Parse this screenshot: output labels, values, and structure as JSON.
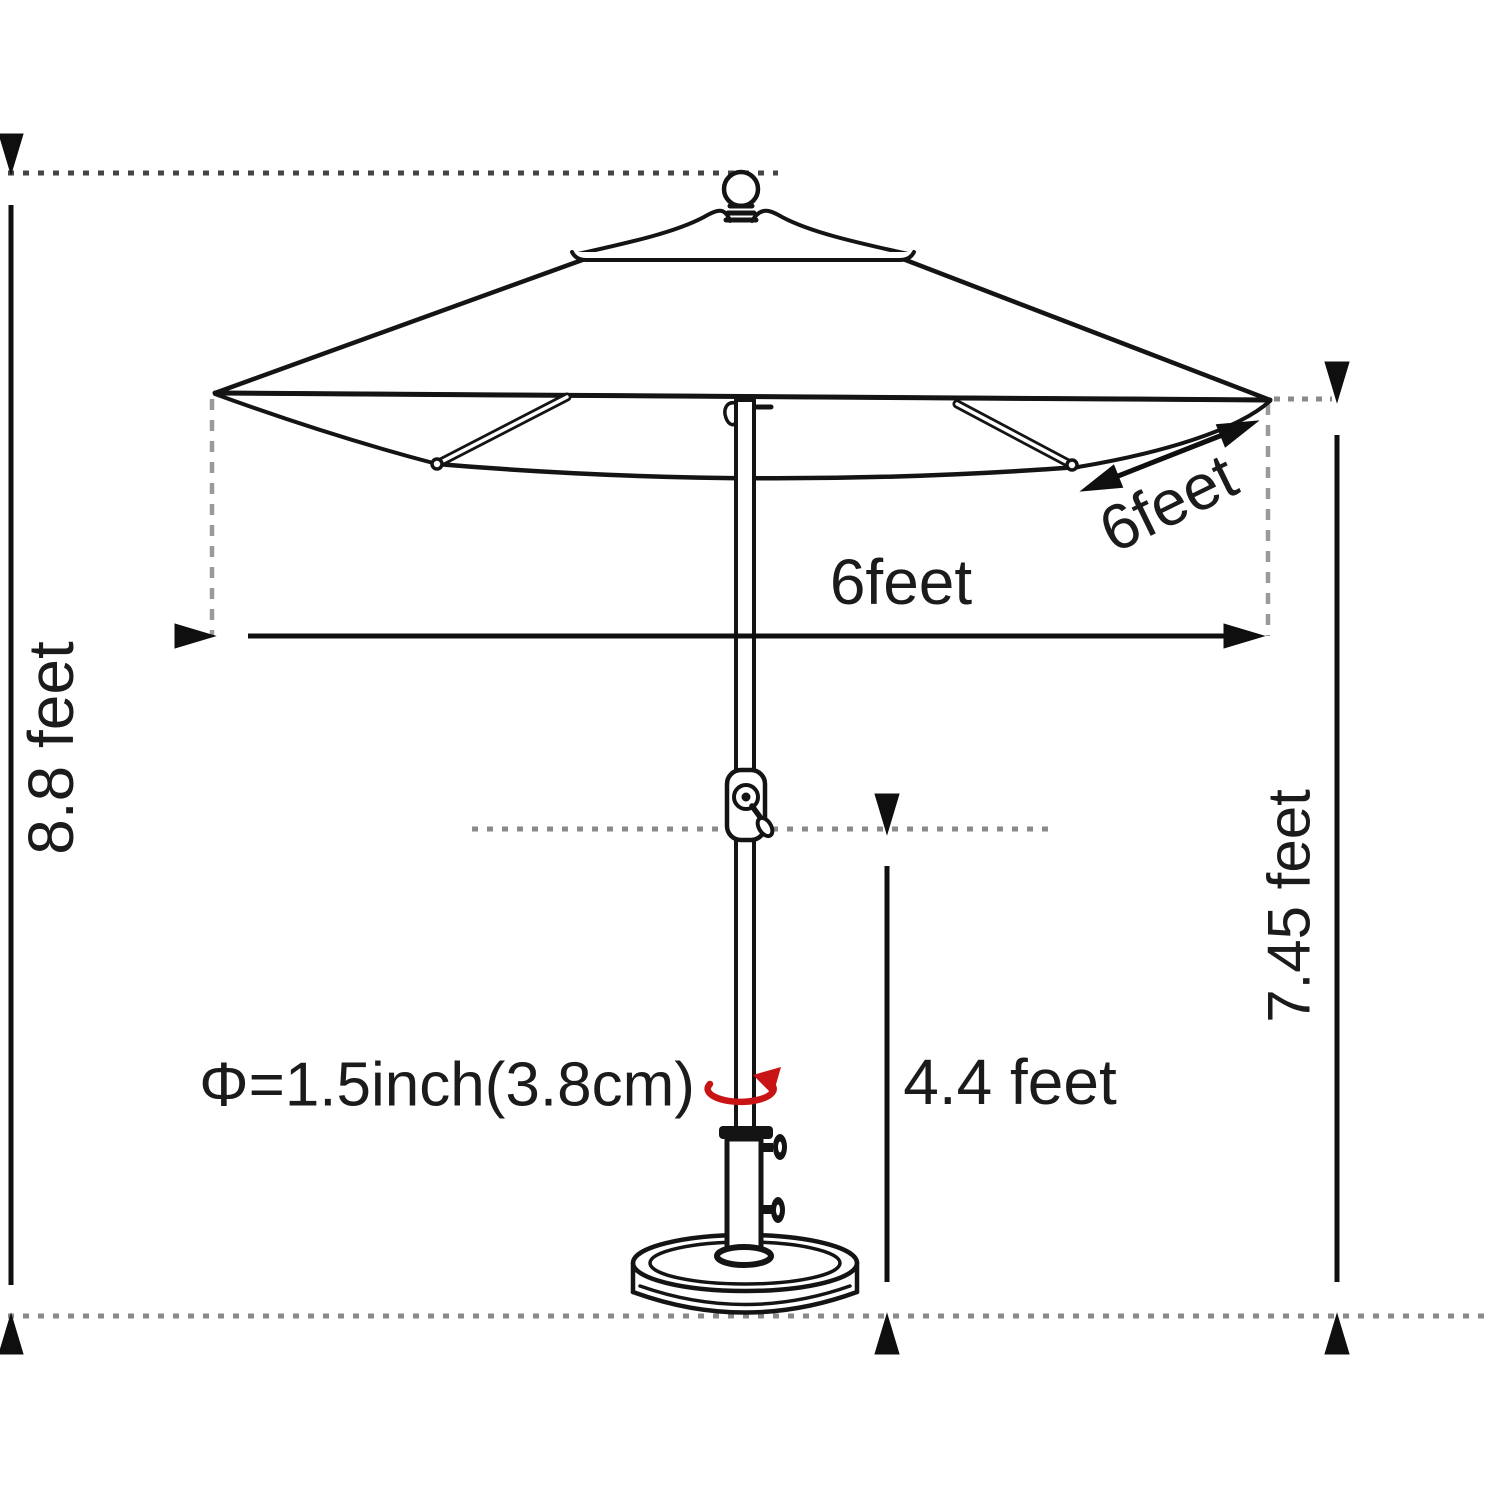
{
  "diagram": {
    "title": "Patio umbrella dimension drawing",
    "labels": {
      "overall_height": "8.8 feet",
      "canopy_clearance_height": "7.45 feet",
      "canopy_width": "6feet",
      "canopy_side_depth": "6feet",
      "ground_to_crank_height": "4.4 feet",
      "pole_diameter": "Φ=1.5inch(3.8cm)"
    },
    "colors": {
      "line": "#141414",
      "guide_dotted": "#4a4a4a",
      "guide_dashed": "#9a9a9a",
      "rotation_arrow": "#c81414",
      "text": "#1b1b1b",
      "background": "#ffffff"
    }
  }
}
